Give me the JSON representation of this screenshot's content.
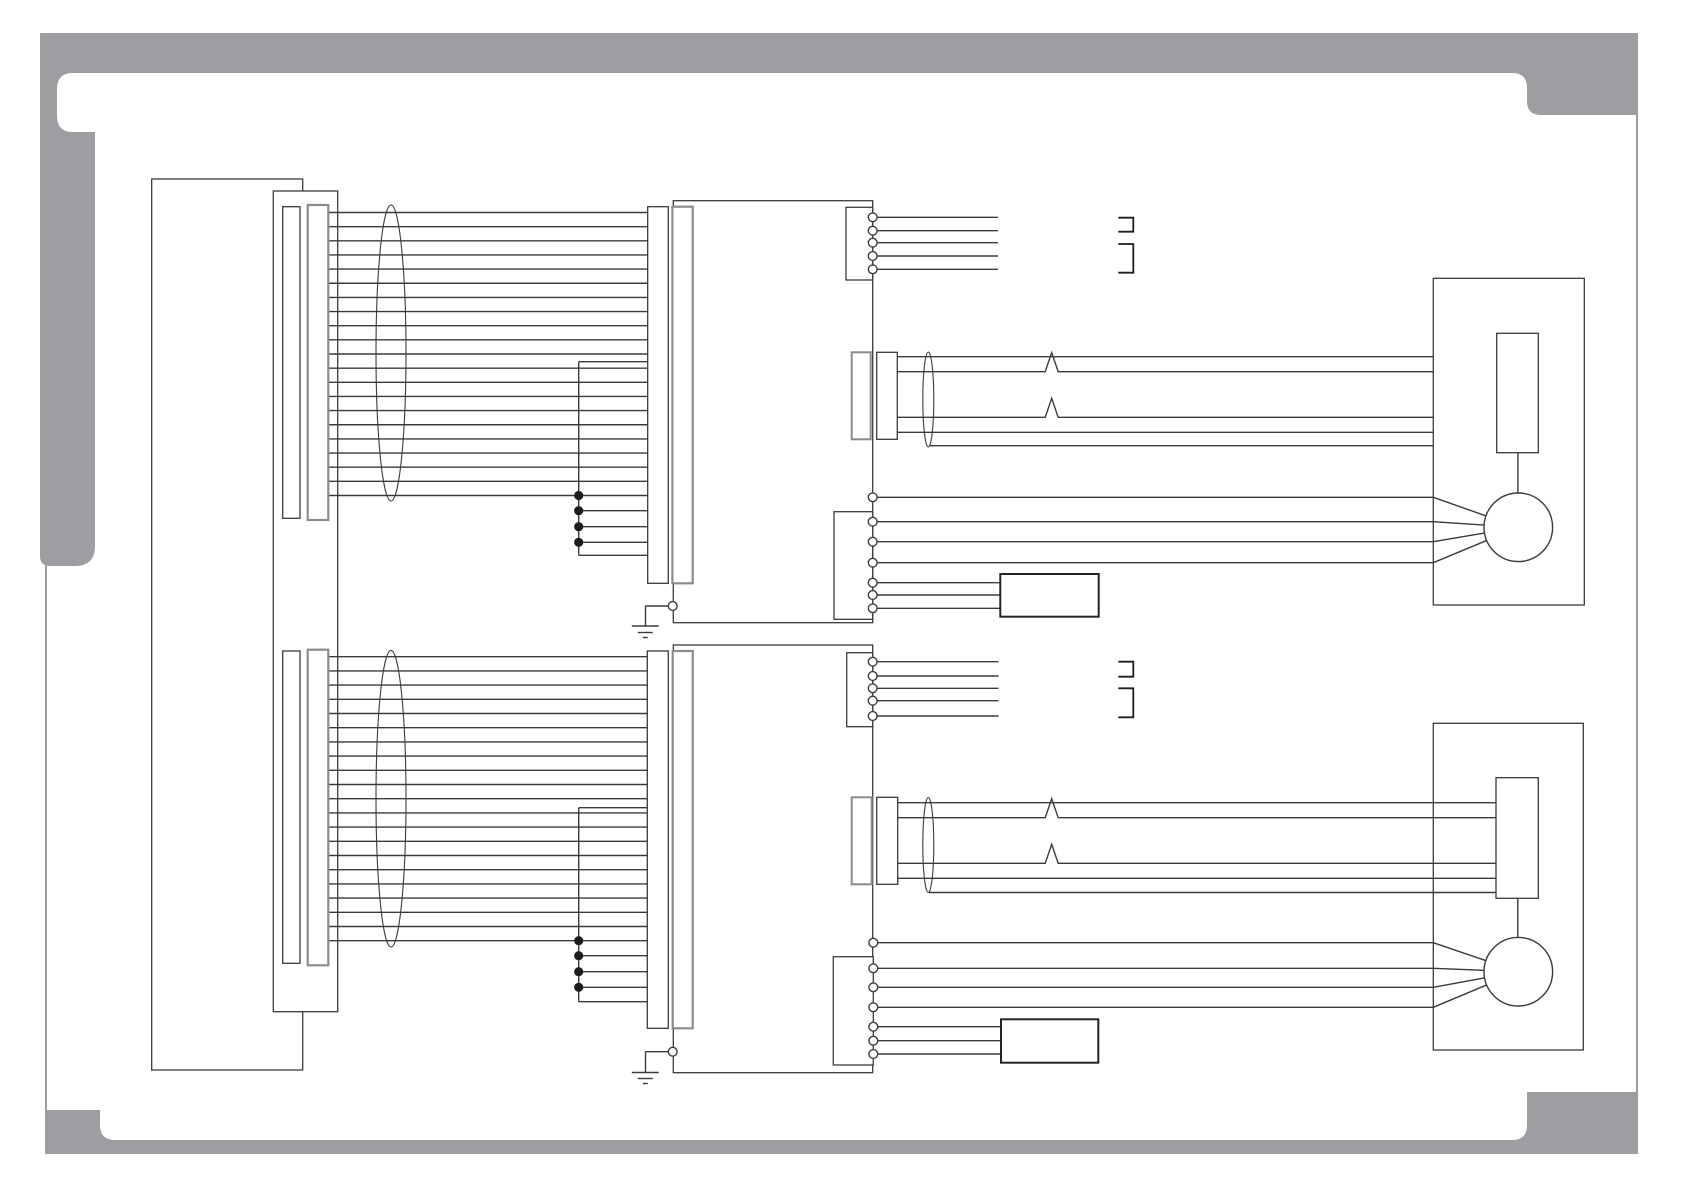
{
  "page": {
    "kind": "wiring-schematic",
    "visible_text": [],
    "colors": {
      "frame_gray": "#9c9ea1",
      "line": "#3b3b3b",
      "dark": "#1d1d1d",
      "gray_line": "#8c8c8c",
      "background": "#ffffff"
    }
  },
  "diagram": {
    "halves": [
      {
        "name": "upper-circuit",
        "harness": {
          "count": 21,
          "x1": 328.3,
          "x2": 647.7,
          "y0": 212.5,
          "dy": 14.15
        },
        "bus": {
          "x": 578.7,
          "y_top": 361.7,
          "y_bottom": 555.3,
          "x2": 648,
          "taps": [
            510.7,
            526.7,
            542.3
          ],
          "junction_dots": [
            495.5,
            510.7,
            526.7,
            542.3
          ]
        },
        "top_connector": {
          "cx": 872.7,
          "pin_radius": 4.4,
          "pins": [
            217.3,
            230.7,
            242.7,
            256,
            269.3
          ],
          "wire_x2": 998
        },
        "brackets": [
          {
            "x1": 1118.3,
            "x2": 1133.3,
            "y1": 217.7,
            "y2": 231.7
          },
          {
            "x1": 1118.3,
            "x2": 1133.3,
            "y1": 244.0,
            "y2": 272.7
          }
        ],
        "mid_cable": {
          "x1": 897.3,
          "x2": 1433.3,
          "wires": [
            356.7,
            371.7,
            417.3,
            432.3
          ],
          "spike_wires": [
            1,
            2
          ],
          "spike_x": 1051.7,
          "spike_h": 19,
          "spike_w": 6.5,
          "shield": {
            "x1": 929,
            "y": 445.7
          }
        },
        "bottom_connector": {
          "cx": 872.7,
          "pin_radius": 4.4,
          "pins": [
            497.3,
            521.7,
            541.7,
            562.7,
            582.7,
            595,
            608.3
          ],
          "motor_pin_count": 4,
          "motor_x": 1433.3,
          "box_x": 1000.3
        },
        "motor_center": {
          "cx": 1518.3,
          "cy": 527.3
        }
      },
      {
        "name": "lower-circuit",
        "harness": {
          "count": 21,
          "x1": 328.3,
          "x2": 647.3,
          "y0": 656.7,
          "dy": 14.2
        },
        "bus": {
          "x": 578.7,
          "y_top": 807.7,
          "y_bottom": 1001.7,
          "x2": 648,
          "taps": [
            955.7,
            971.7,
            987.3
          ],
          "junction_dots": [
            940.7,
            955.7,
            971.7,
            987.3
          ]
        },
        "top_connector": {
          "cx": 872.7,
          "pin_radius": 4.4,
          "pins": [
            661.7,
            676,
            688.3,
            700.7,
            716
          ],
          "wire_x2": 998.5
        },
        "brackets": [
          {
            "x1": 1118.3,
            "x2": 1133.3,
            "y1": 661.7,
            "y2": 676.7
          },
          {
            "x1": 1118.3,
            "x2": 1133.3,
            "y1": 688.3,
            "y2": 717.3
          }
        ],
        "mid_cable": {
          "x1": 897.7,
          "x2": 1496,
          "wires": [
            802.7,
            817.7,
            863.3,
            878.3
          ],
          "spike_wires": [
            1,
            2
          ],
          "spike_x": 1051.7,
          "spike_h": 19,
          "spike_w": 6.5,
          "shield": {
            "x1": 929,
            "y": 892.5
          }
        },
        "bottom_connector": {
          "cx": 873.3,
          "pin_radius": 4.4,
          "pins": [
            942.7,
            968.3,
            987.3,
            1007.3,
            1026.7,
            1040.7,
            1054
          ],
          "motor_pin_count": 4,
          "motor_x": 1433.3,
          "box_x": 1001
        },
        "motor_center": {
          "cx": 1518.3,
          "cy": 971.7
        }
      }
    ]
  }
}
